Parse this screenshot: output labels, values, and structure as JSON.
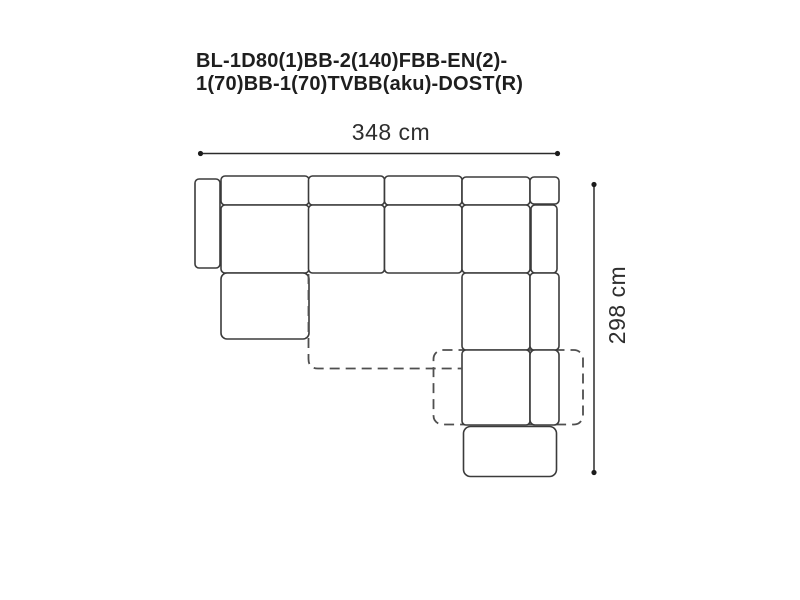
{
  "title": {
    "line1": "BL-1D80(1)BB-2(140)FBB-EN(2)-",
    "line2": "1(70)BB-1(70)TVBB(aku)-DOST(R)"
  },
  "dimensions": {
    "width_label": "348 cm",
    "height_label": "298 cm"
  },
  "diagram": {
    "type": "sofa-top-view-schematic",
    "modules": [
      "left-armrest",
      "back-cushion-1",
      "back-cushion-2",
      "back-cushion-3",
      "back-cushion-4",
      "corner-back-cushion",
      "seat-1",
      "seat-2",
      "seat-3",
      "corner-seat",
      "right-back-strip",
      "left-chaise",
      "corner-lower-seat-1",
      "right-strip-lower-1",
      "corner-lower-seat-2",
      "right-strip-lower-2",
      "bottom-ottoman",
      "pullout-extension-dashed"
    ]
  },
  "colors": {
    "outline": "#3b3b3b",
    "dashed": "#4f4f4f",
    "dimline": "#2b2b2b",
    "text": "#1e1e1e",
    "bg": "#ffffff"
  }
}
